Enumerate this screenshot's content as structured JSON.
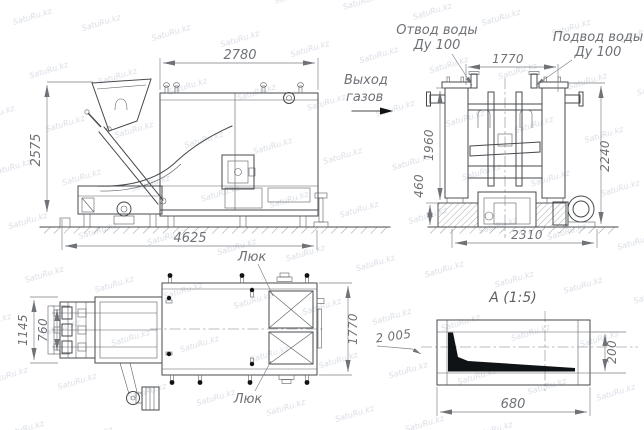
{
  "watermark": {
    "text": "SatuRu.kz"
  },
  "colors": {
    "line": "#45484c",
    "dim_text": "#6e7176",
    "black_fill": "#101316",
    "background": "#ffffff",
    "watermark": "#9aa6bb"
  },
  "views": {
    "side": {
      "dims": {
        "width_top": "2780",
        "height_left": "2575",
        "length_bottom": "4625"
      },
      "labels": {
        "gas_outlet_line1": "Выход",
        "gas_outlet_line2": "газов"
      }
    },
    "front": {
      "labels": {
        "water_outlet_line1": "Отвод воды",
        "water_outlet_line2": "Ду 100",
        "water_inlet_line1": "Подвод воды",
        "water_inlet_line2": "Ду 100"
      },
      "dims": {
        "top": "1770",
        "left_upper": "1960",
        "left_lower": "460",
        "right": "2240",
        "bottom": "2310"
      }
    },
    "plan": {
      "labels": {
        "hatch_top": "Люк",
        "hatch_bottom": "Люк"
      },
      "dims": {
        "left_outer": "1145",
        "left_inner": "760",
        "right": "1770"
      }
    },
    "detail": {
      "title": "А (1:5)",
      "callout": "2 005",
      "dims": {
        "width": "680",
        "height": "200"
      }
    }
  }
}
